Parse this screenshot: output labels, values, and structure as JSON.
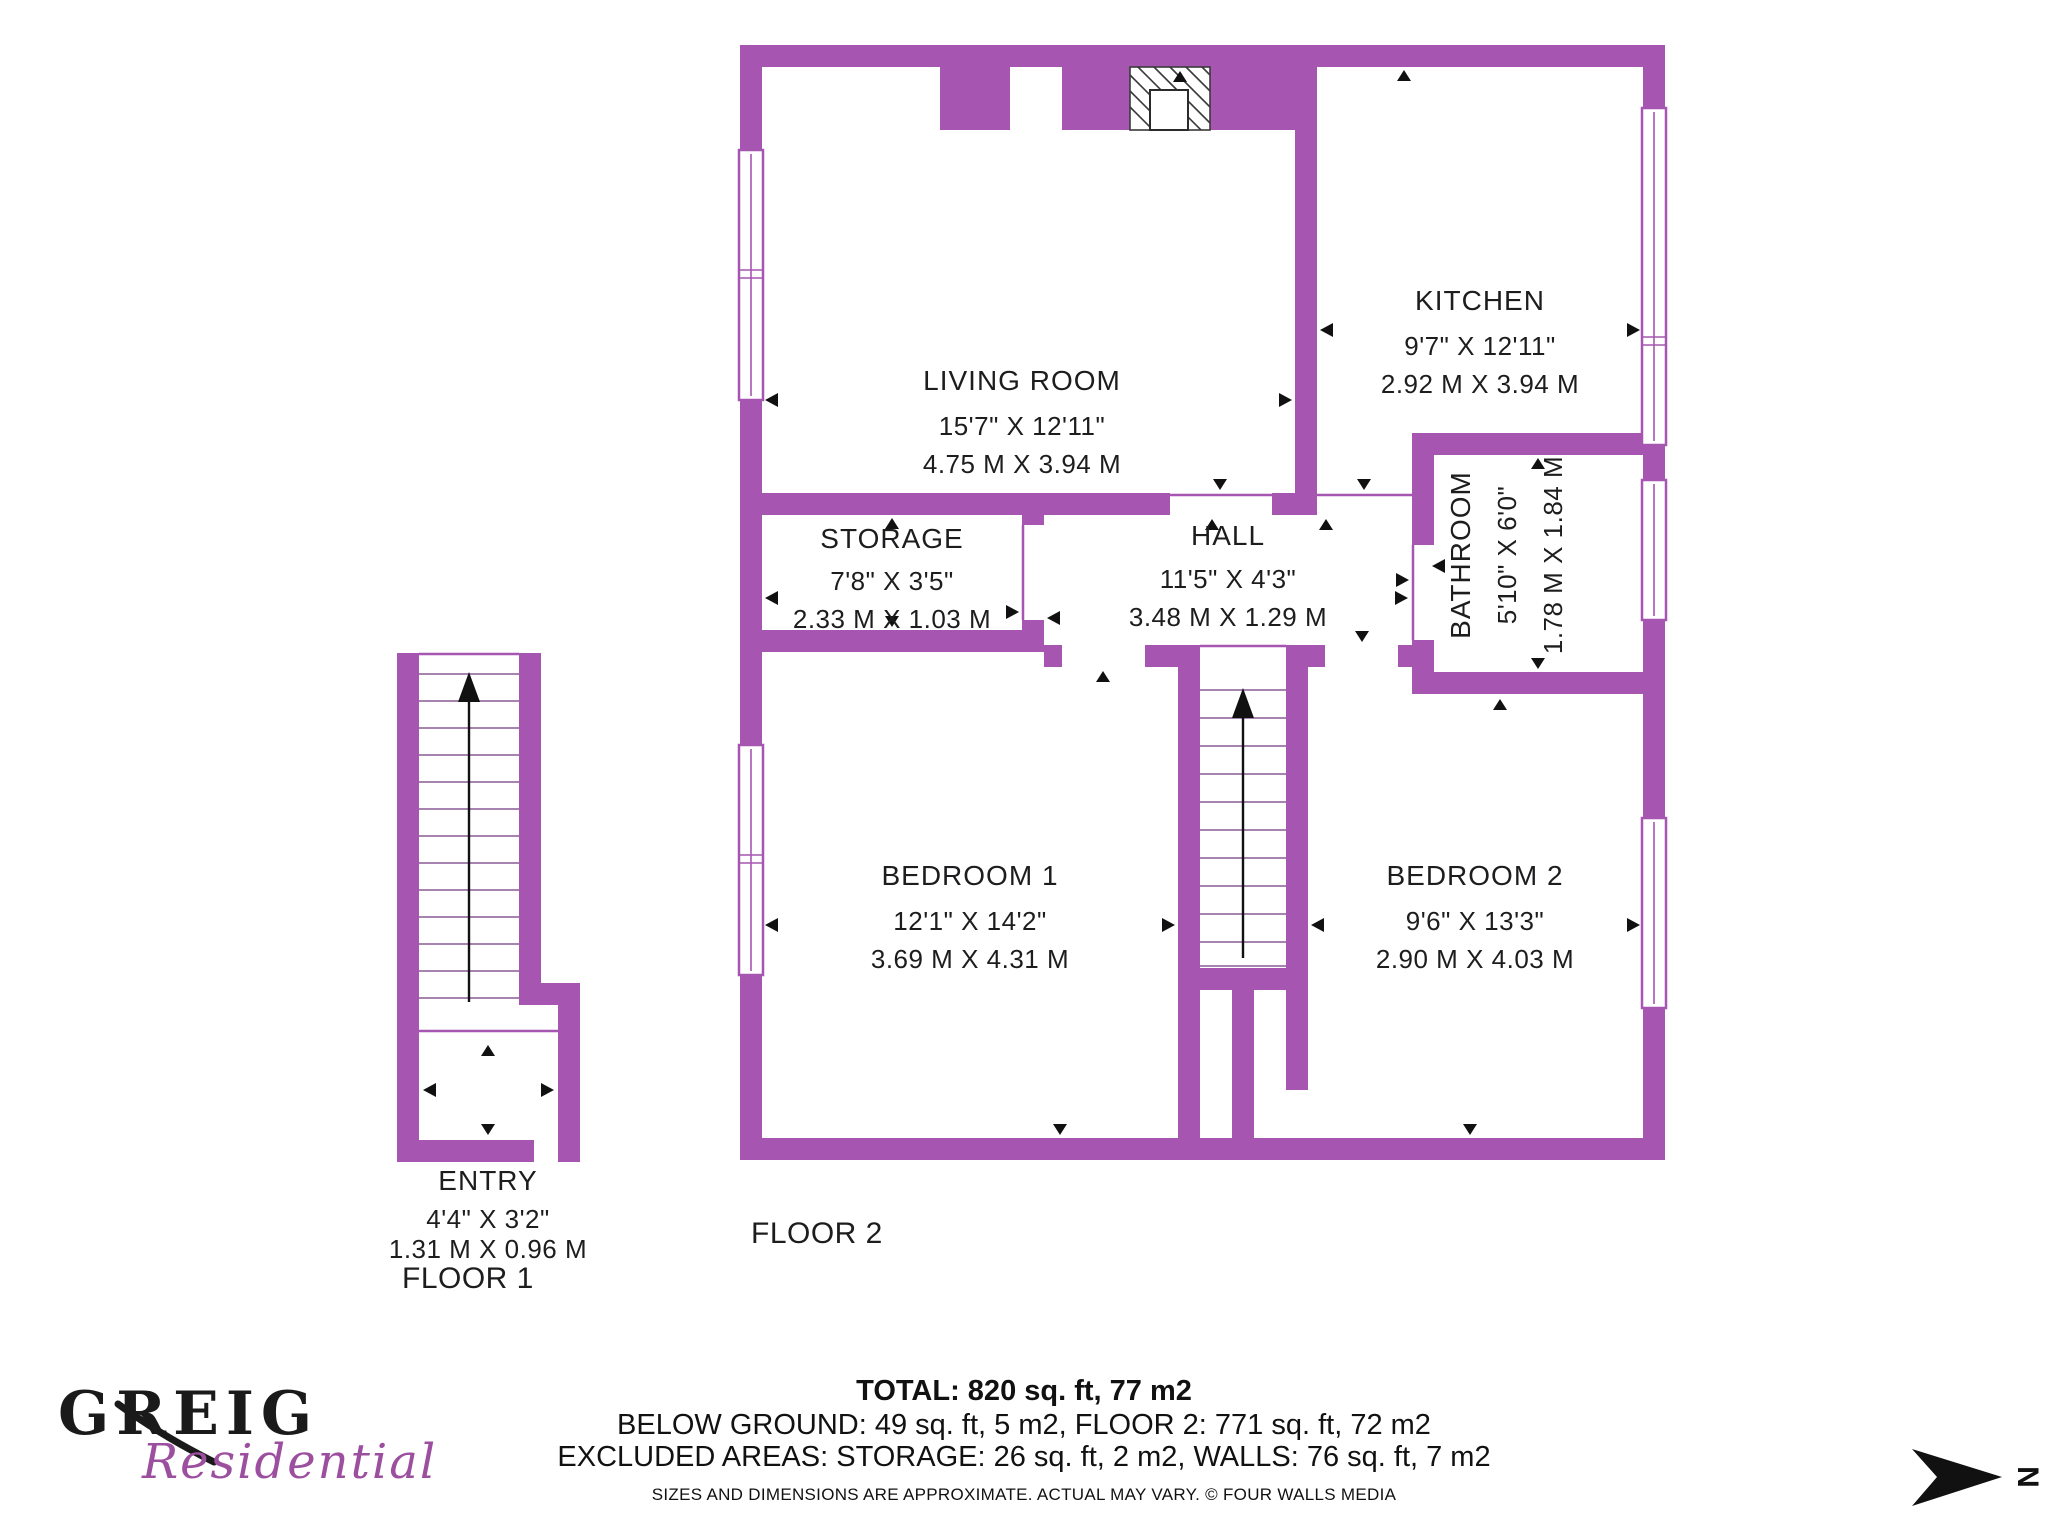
{
  "rooms": {
    "living": {
      "name": "LIVING ROOM",
      "dim_ft": "15'7\" X 12'11\"",
      "dim_m": "4.75 M X 3.94 M"
    },
    "kitchen": {
      "name": "KITCHEN",
      "dim_ft": "9'7\" X 12'11\"",
      "dim_m": "2.92 M X 3.94 M"
    },
    "storage": {
      "name": "STORAGE",
      "dim_ft": "7'8\" X 3'5\"",
      "dim_m": "2.33 M X 1.03 M"
    },
    "hall": {
      "name": "HALL",
      "dim_ft": "11'5\" X 4'3\"",
      "dim_m": "3.48 M X 1.29 M"
    },
    "bathroom": {
      "name": "BATHROOM",
      "dim_ft": "5'10\" X 6'0\"",
      "dim_m": "1.78 M X 1.84 M"
    },
    "bedroom1": {
      "name": "BEDROOM 1",
      "dim_ft": "12'1\" X 14'2\"",
      "dim_m": "3.69 M X 4.31 M"
    },
    "bedroom2": {
      "name": "BEDROOM 2",
      "dim_ft": "9'6\" X 13'3\"",
      "dim_m": "2.90 M X 4.03 M"
    },
    "entry": {
      "name": "ENTRY",
      "dim_ft": "4'4\" X 3'2\"",
      "dim_m": "1.31 M X 0.96 M"
    }
  },
  "floors": {
    "floor1_label": "FLOOR 1",
    "floor2_label": "FLOOR 2"
  },
  "summary": {
    "total": "TOTAL: 820 sq. ft, 77 m2",
    "line2": "BELOW GROUND: 49 sq. ft, 5 m2, FLOOR 2: 771 sq. ft, 72 m2",
    "line3": "EXCLUDED AREAS: STORAGE: 26 sq. ft, 2 m2, WALLS: 76 sq. ft, 7 m2",
    "disclaimer": "SIZES AND DIMENSIONS ARE APPROXIMATE. ACTUAL MAY VARY. © FOUR WALLS MEDIA"
  },
  "logo": {
    "primary": "GREIG",
    "secondary": "Residential"
  },
  "compass": {
    "label": "N"
  },
  "colors": {
    "wall": "#A656B0",
    "text": "#1d1d1f",
    "logo_script": "#9C4F9F",
    "hatch": "#3a3a3a",
    "arrow": "#111111"
  }
}
